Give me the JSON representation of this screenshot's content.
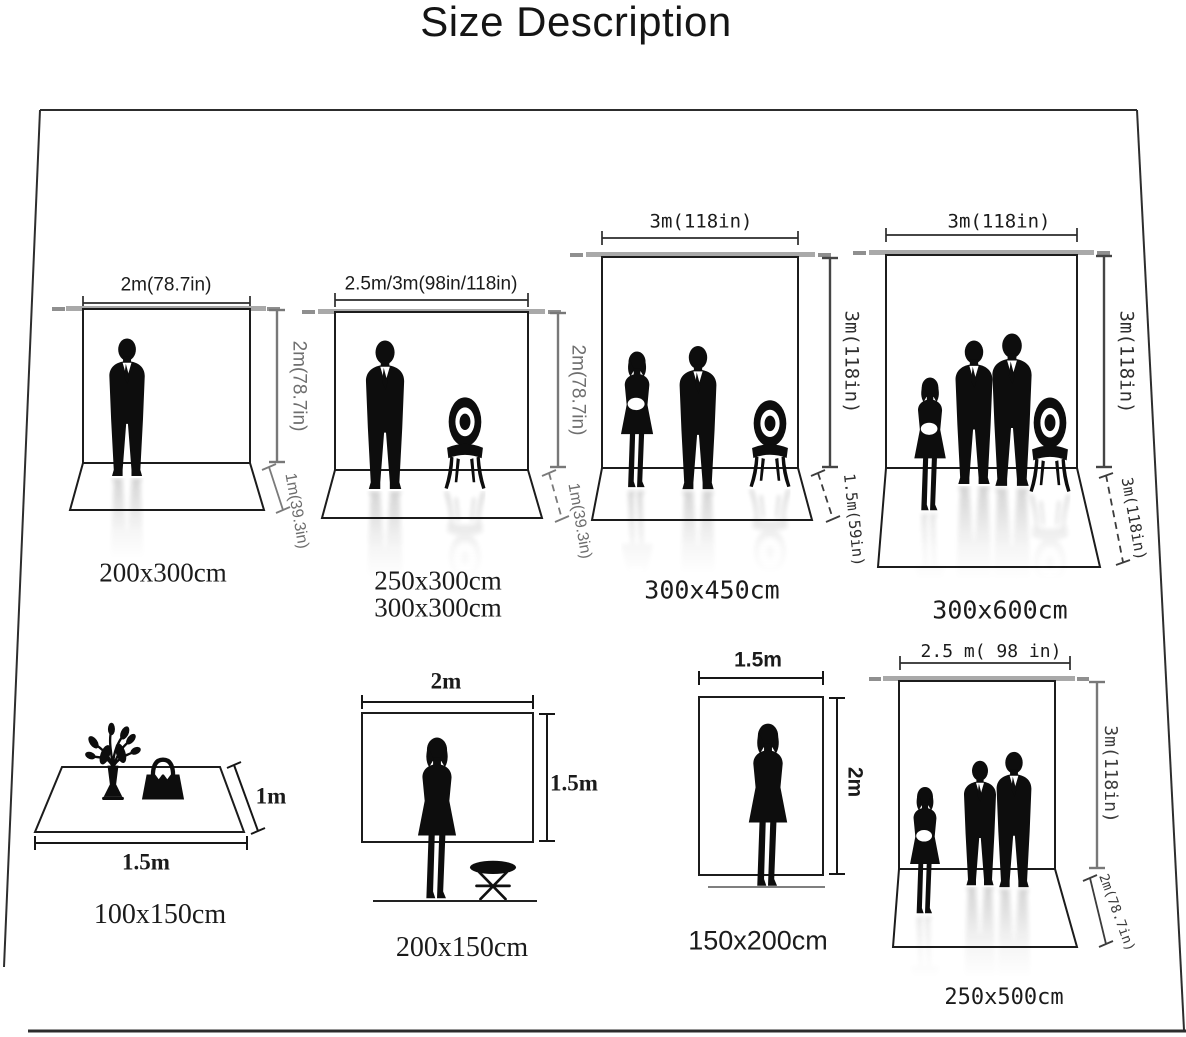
{
  "title": "Size Description",
  "panels": [
    {
      "name": "backdrop-200x300",
      "width_label": "2m(78.7in)",
      "height_label": "2m(78.7in)",
      "floor_label": "1m(39.3in)",
      "size_label": "200x300cm"
    },
    {
      "name": "backdrop-250x300-300x300",
      "width_label": "2.5m/3m(98in/118in)",
      "height_label": "2m(78.7in)",
      "floor_label": "1m(39.3in)",
      "size_label_1": "250x300cm",
      "size_label_2": "300x300cm"
    },
    {
      "name": "backdrop-300x450",
      "width_label": "3m(118in)",
      "height_label": "3m(118in)",
      "floor_label": "1.5m(59in)",
      "size_label": "300x450cm"
    },
    {
      "name": "backdrop-300x600",
      "width_label": "3m(118in)",
      "height_label": "3m(118in)",
      "floor_label": "3m(118in)",
      "size_label": "300x600cm"
    },
    {
      "name": "rug-100x150",
      "depth_label": "1m",
      "width_label": "1.5m",
      "size_label": "100x150cm"
    },
    {
      "name": "backdrop-200x150",
      "width_label": "2m",
      "height_label": "1.5m",
      "size_label": "200x150cm"
    },
    {
      "name": "backdrop-150x200",
      "width_label": "1.5m",
      "height_label": "2m",
      "size_label": "150x200cm"
    },
    {
      "name": "backdrop-250x500",
      "width_label": "2.5 m( 98 in)",
      "height_label": "3m(118in)",
      "floor_label": "2m(78.7in)",
      "size_label": "250x500cm"
    }
  ]
}
